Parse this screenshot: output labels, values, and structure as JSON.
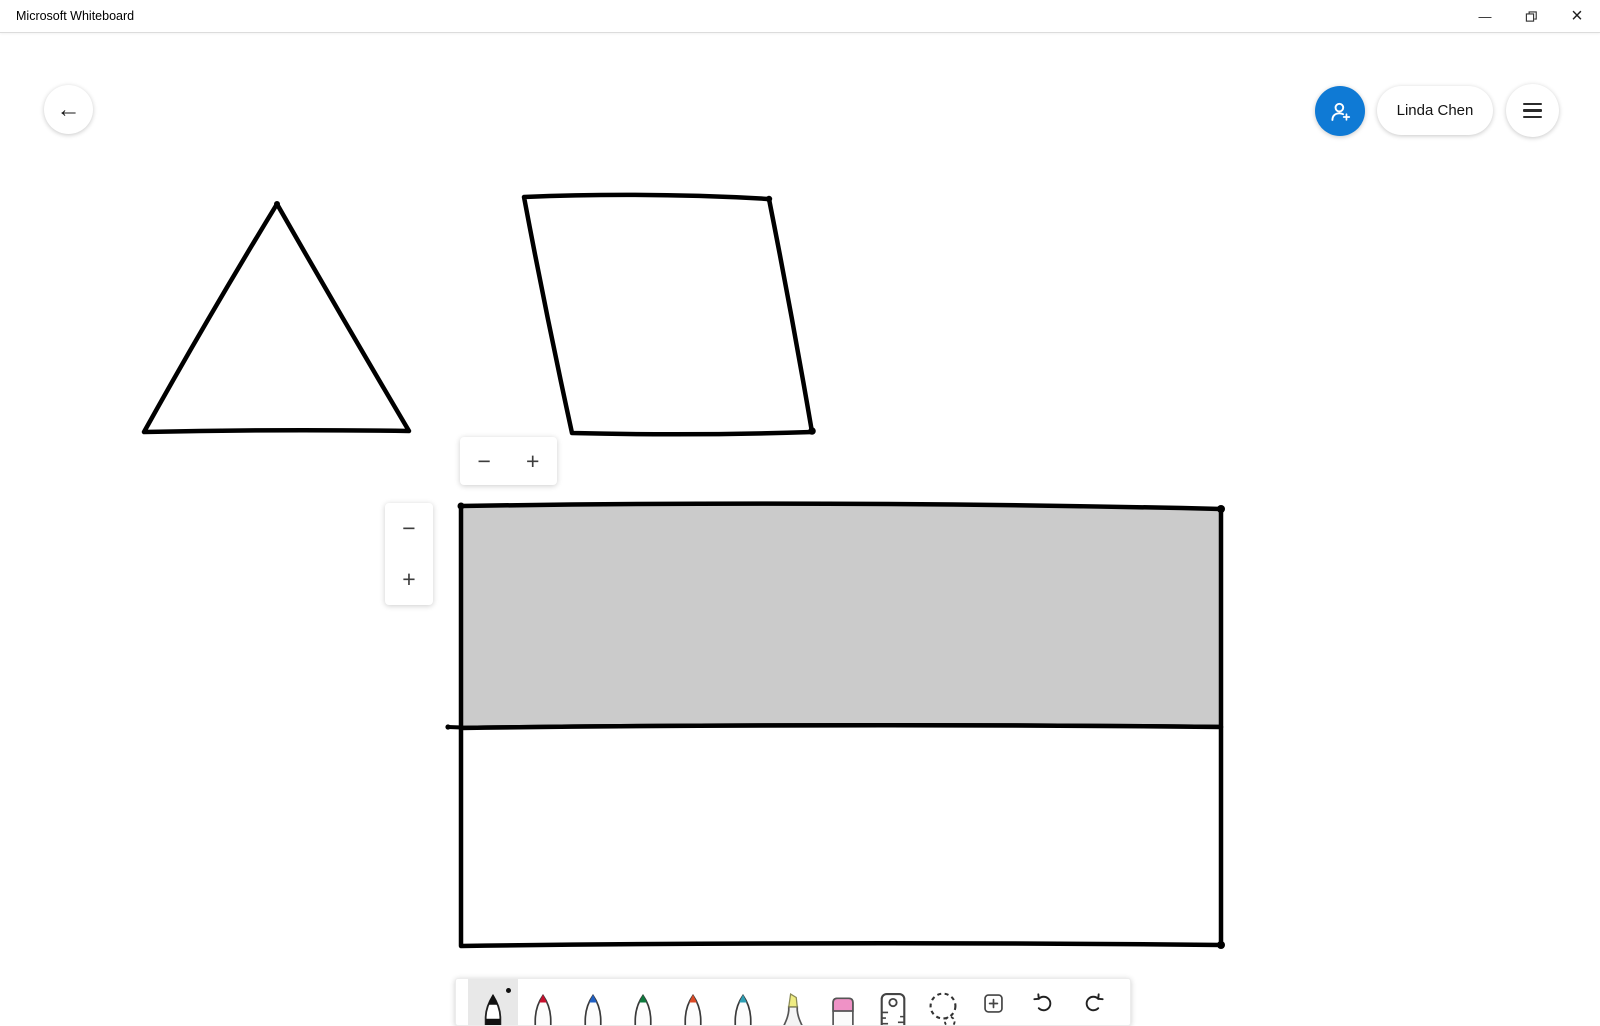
{
  "window": {
    "title": "Microsoft Whiteboard",
    "minimize_glyph": "—",
    "close_glyph": "×"
  },
  "topbar": {
    "back_glyph": "←",
    "user_name": "Linda Chen"
  },
  "zoom_controls": {
    "horizontal": {
      "minus_glyph": "−",
      "plus_glyph": "+"
    },
    "vertical": {
      "minus_glyph": "−",
      "plus_glyph": "+"
    }
  },
  "canvas": {
    "ink_color": "#000000",
    "shapes": [
      {
        "name": "triangle",
        "fill": "none"
      },
      {
        "name": "parallelogram",
        "fill": "none"
      },
      {
        "name": "large-rectangle-top-half",
        "fill": "#cbcbcb"
      },
      {
        "name": "large-rectangle-bottom-half",
        "fill": "#ffffff"
      }
    ]
  },
  "toolbar": {
    "selected_tool": "black-pen",
    "selected_bg": "#e8e8e8",
    "tools": [
      {
        "name": "black-pen",
        "selected": true,
        "color": "#111111"
      },
      {
        "name": "red-pen",
        "color": "#c8102e"
      },
      {
        "name": "blue-pen",
        "color": "#2060c4"
      },
      {
        "name": "green-pen",
        "color": "#0e7a3d"
      },
      {
        "name": "orange-pen",
        "color": "#dc4a26"
      },
      {
        "name": "teal-pen",
        "color": "#2e9fb5"
      },
      {
        "name": "highlighter",
        "color": "#efec82"
      },
      {
        "name": "eraser",
        "color": "#ef92c6"
      },
      {
        "name": "ruler"
      },
      {
        "name": "lasso-select"
      },
      {
        "name": "insert"
      },
      {
        "name": "undo"
      },
      {
        "name": "redo"
      }
    ]
  },
  "colors": {
    "accent_blue": "#0f7ad5",
    "ink": "#000000",
    "shape_fill_gray": "#cbcbcb"
  }
}
